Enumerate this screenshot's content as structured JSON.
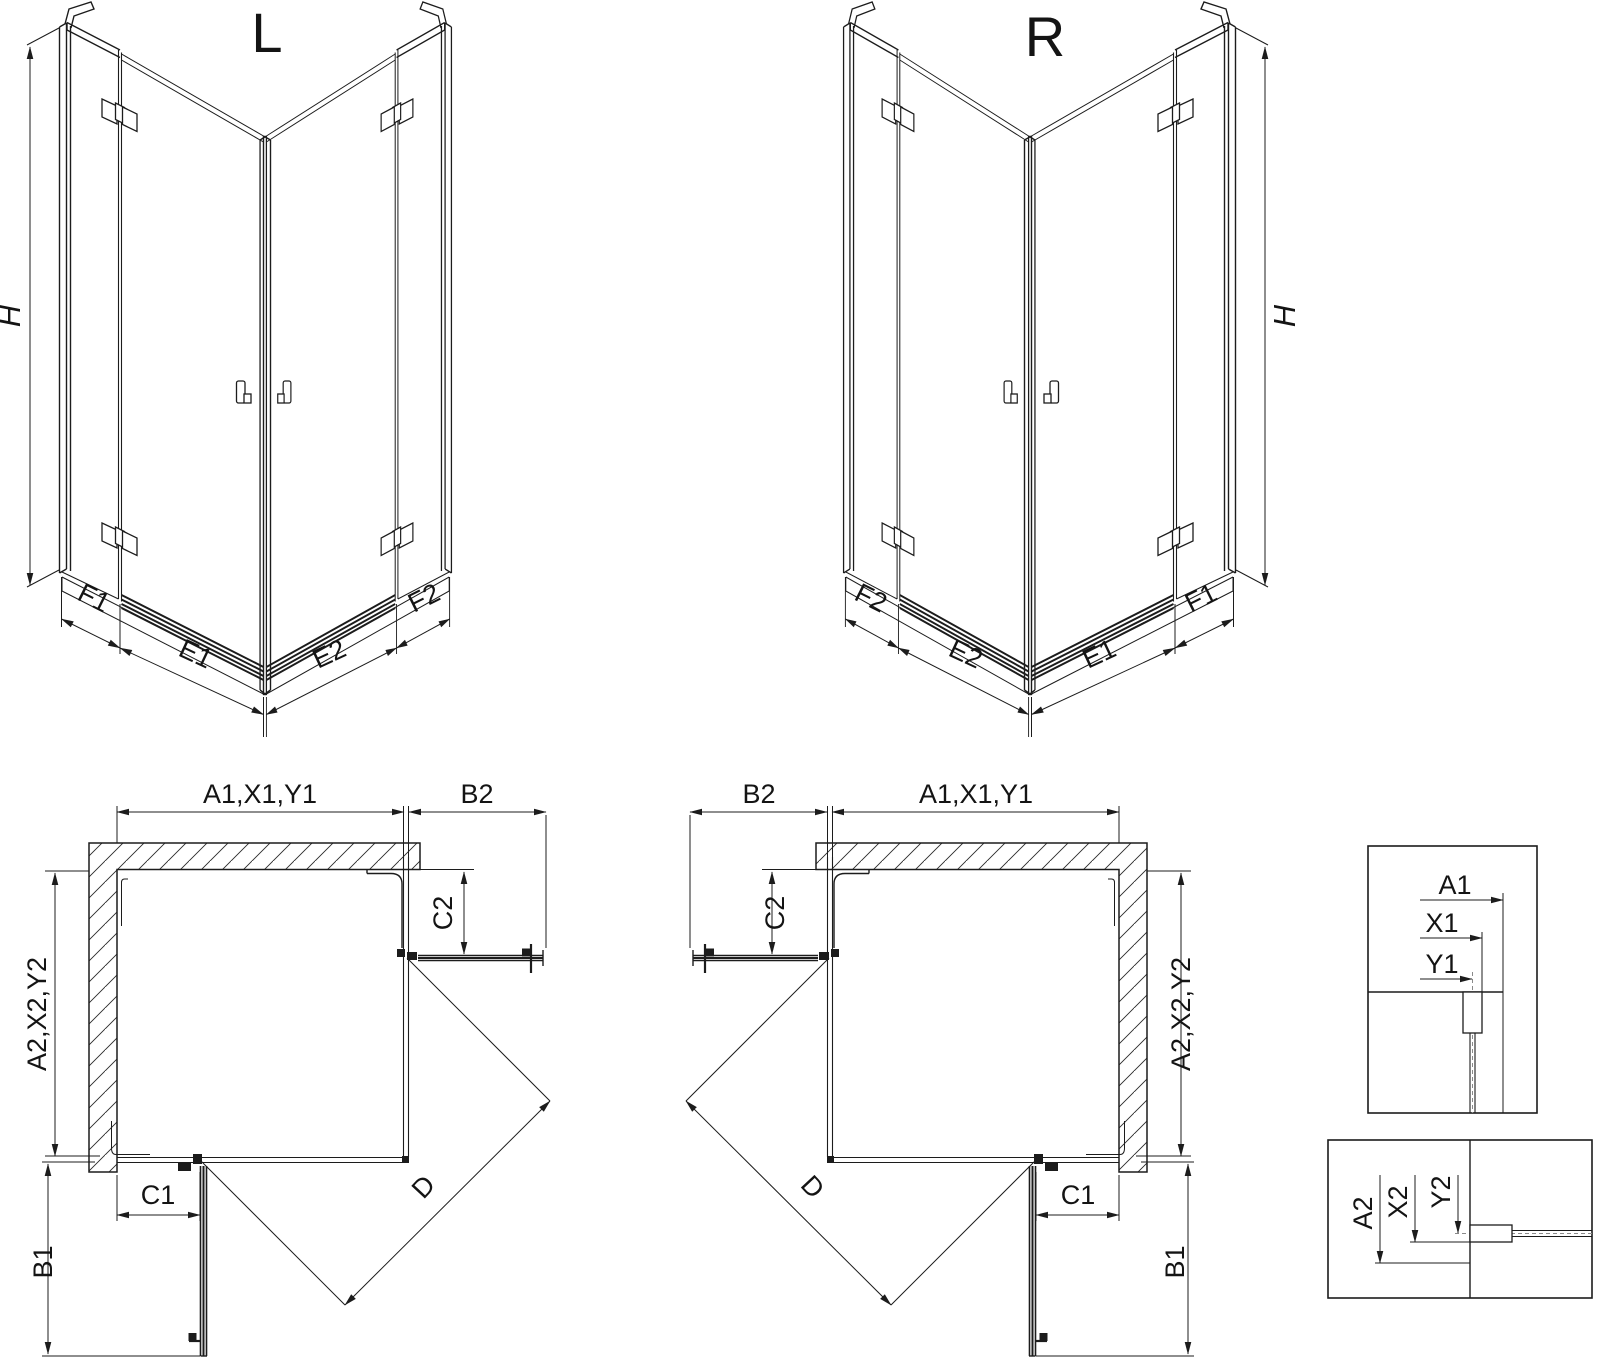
{
  "iso_left": {
    "title": "L",
    "height_label": "H",
    "base_labels": [
      "F1",
      "E1",
      "E2",
      "F2"
    ]
  },
  "iso_right": {
    "title": "R",
    "height_label": "H",
    "base_labels": [
      "F2",
      "E2",
      "E1",
      "F1"
    ]
  },
  "plan_left": {
    "top_width": "A1,X1,Y1",
    "open_door_top": "B2",
    "fixed_panel_right": "C2",
    "side_depth": "A2,X2,Y2",
    "fixed_panel_bottom": "C1",
    "open_door_bottom": "B1",
    "diagonal_entry": "D"
  },
  "plan_right": {
    "open_door_top": "B2",
    "top_width": "A1,X1,Y1",
    "fixed_panel_right": "C2",
    "side_depth": "A2,X2,Y2",
    "fixed_panel_bottom": "C1",
    "open_door_bottom": "B1",
    "diagonal_entry": "D"
  },
  "detail_width": {
    "dim1": "A1",
    "dim2": "X1",
    "dim3": "Y1"
  },
  "detail_depth": {
    "dim1": "A2",
    "dim2": "X2",
    "dim3": "Y2"
  },
  "colors": {
    "line": "#1c1c1c",
    "centerline": "#8a8a8a",
    "background": "#ffffff"
  }
}
